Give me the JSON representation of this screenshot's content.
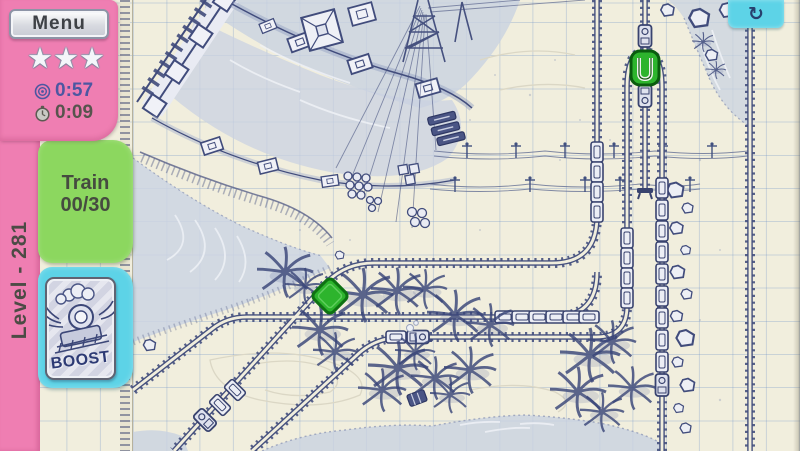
{
  "hud": {
    "menu": "Menu",
    "stars": 3,
    "time_goal": "0:57",
    "time_elapsed": "0:09",
    "train_label": "Train",
    "train_progress": "00/30",
    "level": "Level - 281",
    "boost": "BOOST",
    "refresh_icon": "↻",
    "star_icon": "★"
  },
  "colors": {
    "pink": "#ef7eb2",
    "green_tab": "#8cd75f",
    "cyan": "#5dd3e7",
    "paper": "#f1eedd",
    "ink": "#414c7c",
    "goal_time_text": "#4c57a1",
    "elapsed_time_text": "#57544d",
    "marker_green": "#2db42d"
  },
  "map": {
    "diamond_switch_color": "#2db42d",
    "station_marker_color": "#2db42d"
  }
}
